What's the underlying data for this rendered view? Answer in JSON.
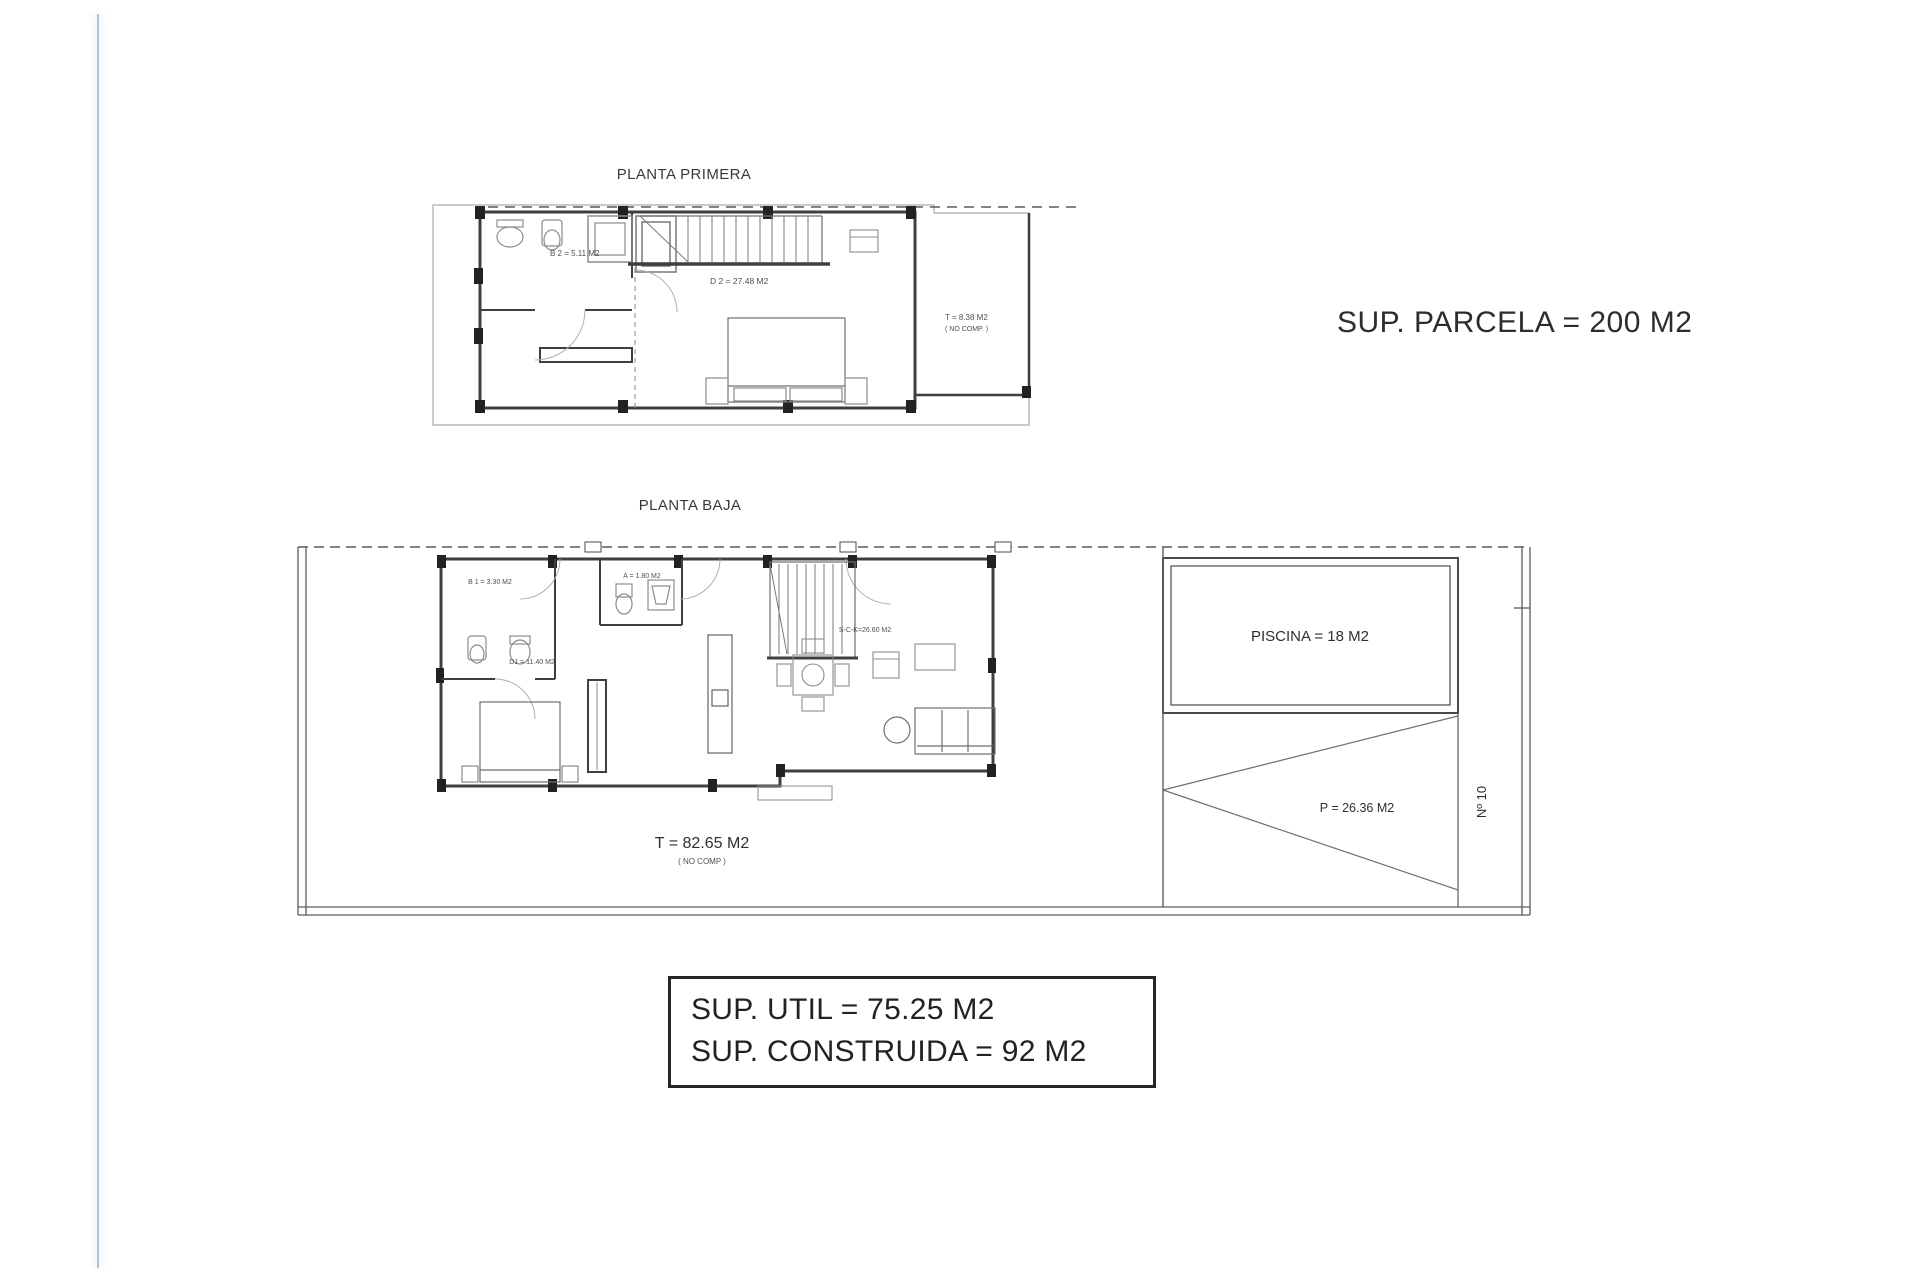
{
  "annotations": {
    "parcel_area": "SUP. PARCELA = 200 M2"
  },
  "first_floor": {
    "title": "PLANTA PRIMERA",
    "labels": {
      "bathroom": "B 2 = 5.11 M2",
      "bedroom": "D 2 = 27.48 M2",
      "terrace_line1": "T = 8.38 M2",
      "terrace_line2": "( NO COMP. )"
    }
  },
  "ground_floor": {
    "title": "PLANTA BAJA",
    "labels": {
      "bathroom": "B 1 = 3.30 M2",
      "aseo": "A = 1.80 M2",
      "bedroom": "D1 = 11.40 M2",
      "living_kitchen": "S-C-K=26.60 M2",
      "pool": "PISCINA = 18 M2",
      "parking": "P = 26.36 M2",
      "plot_number": "Nº 10",
      "terrace_line1": "T = 82.65 M2",
      "terrace_line2": "( NO COMP )"
    }
  },
  "summary_box": {
    "line1": "SUP. UTIL = 75.25 M2",
    "line2": "SUP. CONSTRUIDA = 92 M2"
  },
  "colors": {
    "wall": "#3f3f3f",
    "furniture": "#8c8c8c",
    "thin_outline": "#a8adad",
    "edge_glow": "#b6c2c6"
  }
}
